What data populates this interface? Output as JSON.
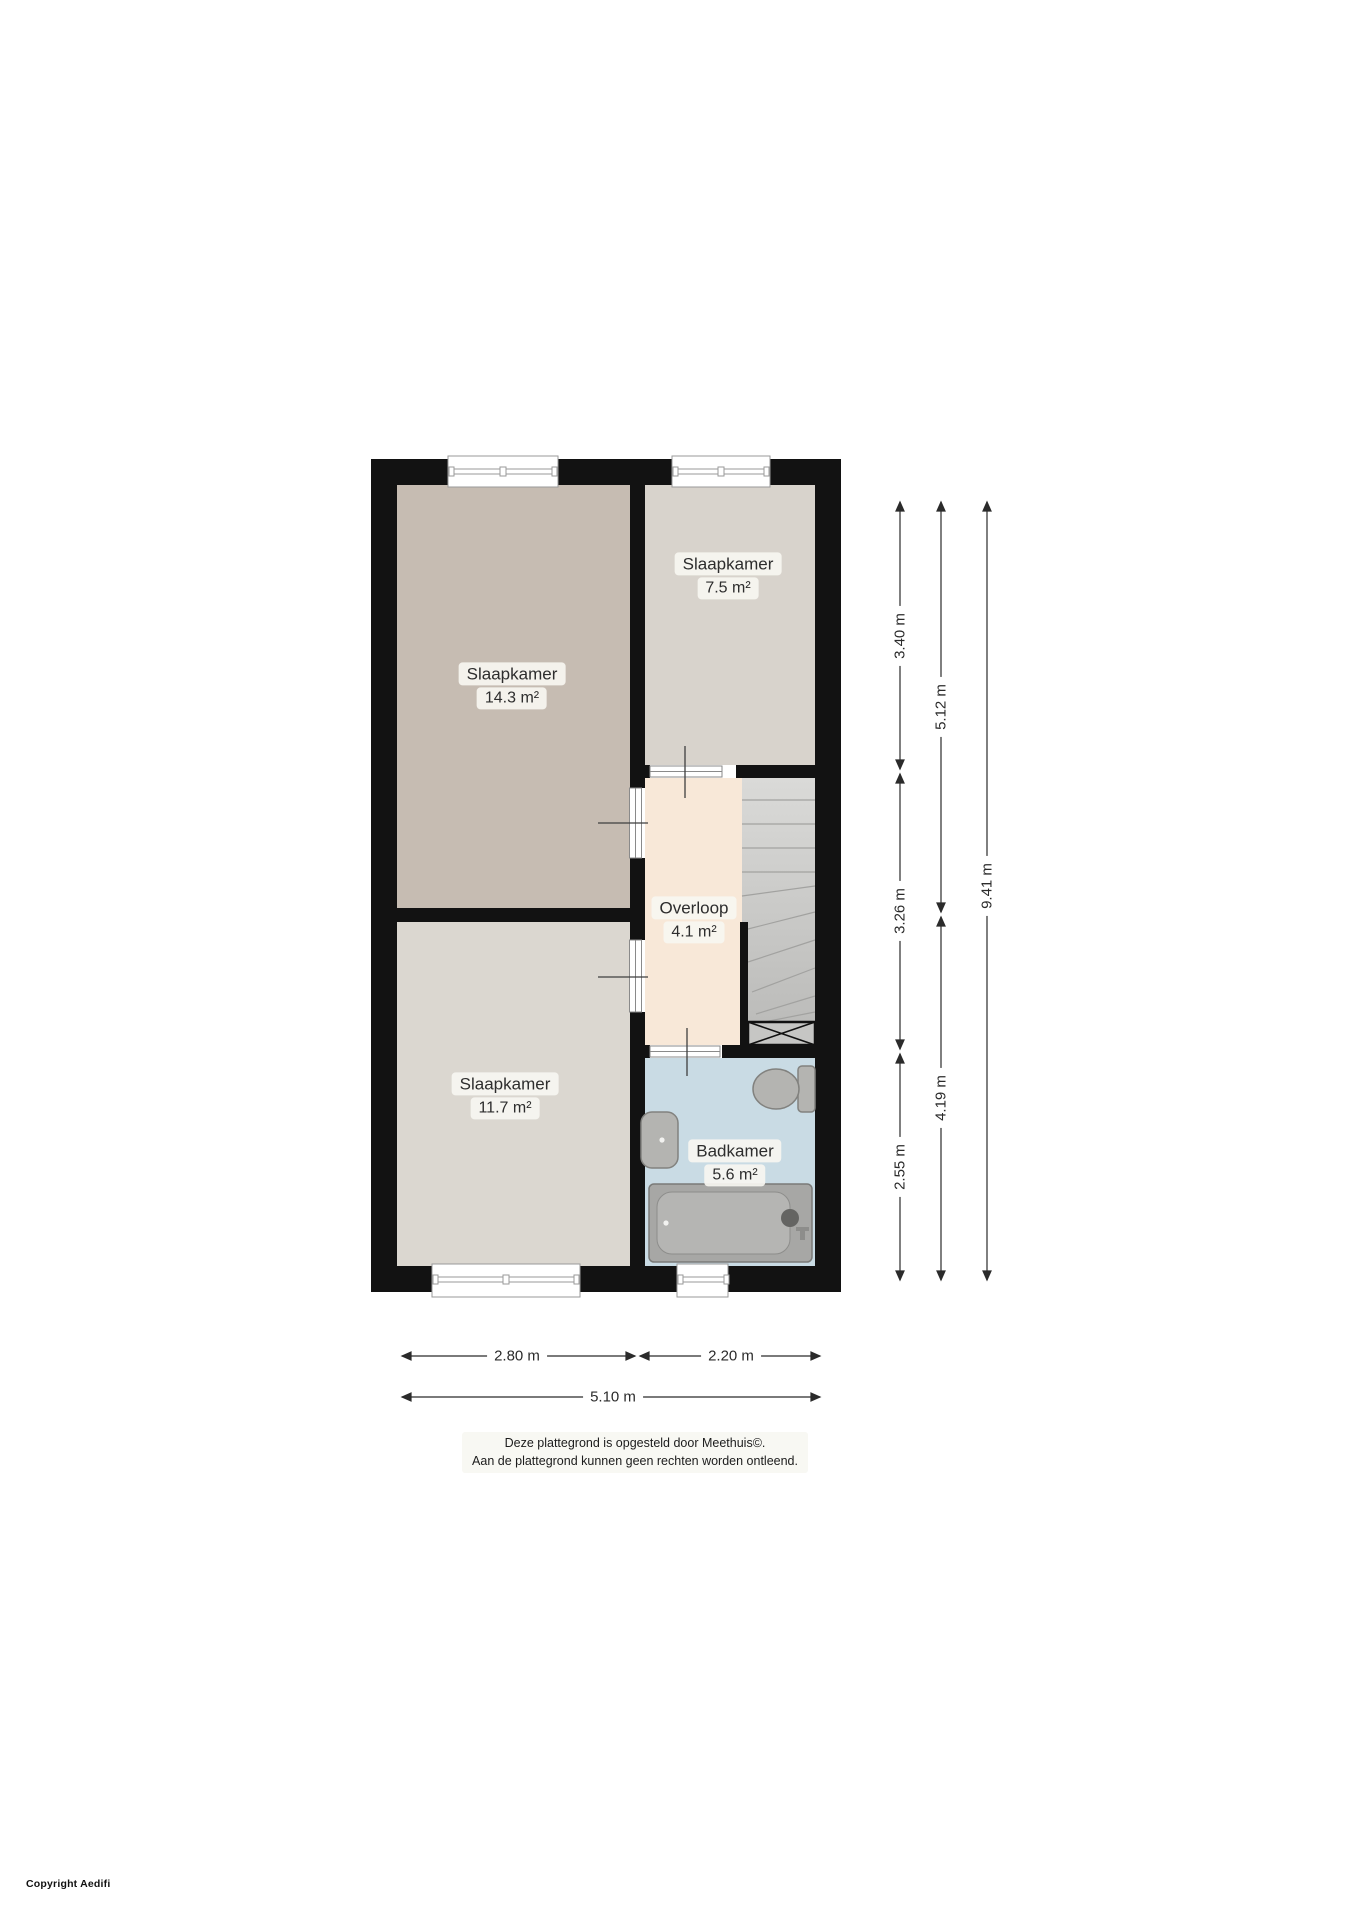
{
  "rooms": [
    {
      "name": "Slaapkamer",
      "area": "14.3 m²"
    },
    {
      "name": "Slaapkamer",
      "area": "7.5 m²"
    },
    {
      "name": "Overloop",
      "area": "4.1 m²"
    },
    {
      "name": "Slaapkamer",
      "area": "11.7 m²"
    },
    {
      "name": "Badkamer",
      "area": "5.6 m²"
    }
  ],
  "dimension_labels": {
    "d340": "3.40 m",
    "d326": "3.26 m",
    "d255": "2.55 m",
    "d512": "5.12 m",
    "d419": "4.19 m",
    "d941": "9.41 m",
    "d280": "2.80 m",
    "d220": "2.20 m",
    "d510": "5.10 m"
  },
  "footer": {
    "line1": "Deze plattegrond is opgesteld door Meethuis©.",
    "line2": "Aan de plattegrond kunnen geen rechten worden ontleend."
  },
  "copyright": "Copyright Aedifi",
  "colors": {
    "wall": "#121212",
    "bedroom_14_floor": "#c6bcb2",
    "bedroom_7_floor": "#d8d3cc",
    "bedroom_11_floor": "#dbd7d0",
    "overloop_floor": "#f8e8d8",
    "badkamer_floor": "#c9dbe4",
    "stairs_fill": "#cfcfcd",
    "fixture_fill": "#b4b4b1",
    "dim_color": "#2b2b2b"
  }
}
